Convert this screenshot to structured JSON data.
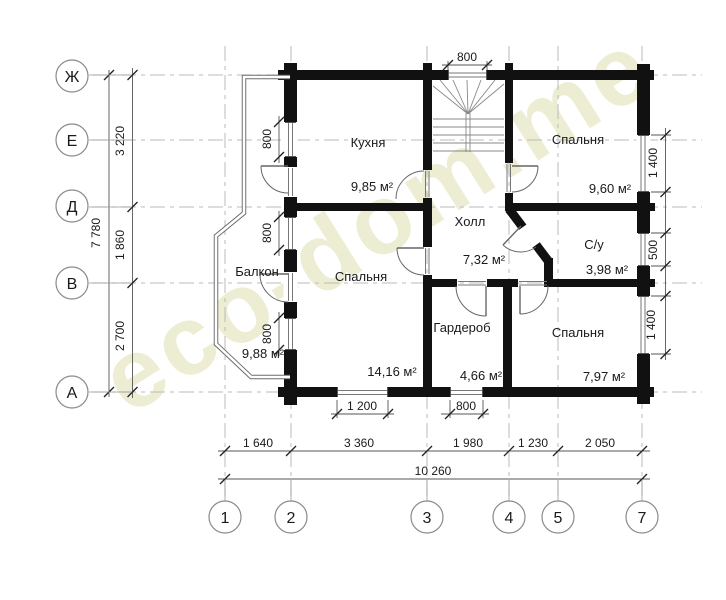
{
  "watermark": "eco-dom.me",
  "axis": {
    "rows": [
      "Ж",
      "Е",
      "Д",
      "В",
      "А"
    ],
    "cols": [
      "1",
      "2",
      "3",
      "4",
      "5",
      "7"
    ]
  },
  "rooms": {
    "kitchen": {
      "name": "Кухня",
      "area": "9,85 м²"
    },
    "bedroom_top": {
      "name": "Спальня",
      "area": "9,60 м²"
    },
    "hall": {
      "name": "Холл",
      "area": "7,32 м²"
    },
    "bathroom": {
      "name": "С/у",
      "area": "3,98 м²"
    },
    "balcony": {
      "name": "Балкон",
      "area": "9,88 м²"
    },
    "bedroom_left": {
      "name": "Спальня",
      "area": "14,16 м²"
    },
    "wardrobe": {
      "name": "Гардероб",
      "area": "4,66 м²"
    },
    "bedroom_bottom": {
      "name": "Спальня",
      "area": "7,97 м²"
    }
  },
  "dims": {
    "top_window": "800",
    "left_windows": [
      "800",
      "800",
      "800"
    ],
    "left_chain": [
      "3 220",
      "1 860",
      "2 700"
    ],
    "left_total": "7 780",
    "right_windows": [
      "1 400",
      "500",
      "1 400"
    ],
    "bottom_windows": [
      "1 200",
      "800"
    ],
    "bottom_chain": [
      "1 640",
      "3 360",
      "1 980",
      "1 230",
      "2 050"
    ],
    "bottom_total": "10 260"
  },
  "colors": {
    "wall": "#111111",
    "grid": "#bbbbbb",
    "watermark": "#ecedd2"
  }
}
